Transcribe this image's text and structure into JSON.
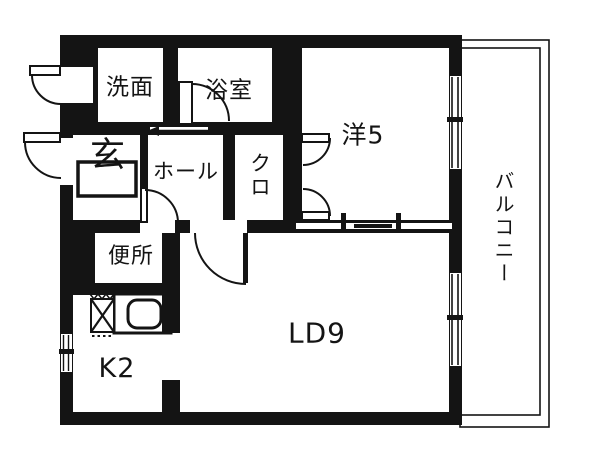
{
  "type": "apartment-floor-plan",
  "colors": {
    "ink": "#141414",
    "bg": "#ffffff"
  },
  "rooms": [
    {
      "id": "washroom",
      "label": "洗面"
    },
    {
      "id": "bathroom",
      "label": "浴室"
    },
    {
      "id": "western-room",
      "label": "洋5"
    },
    {
      "id": "entrance",
      "label": "玄"
    },
    {
      "id": "hall",
      "label": "ホール"
    },
    {
      "id": "closet",
      "label": "クロ"
    },
    {
      "id": "toilet",
      "label": "便所"
    },
    {
      "id": "kitchen",
      "label": "K2"
    },
    {
      "id": "living-dining",
      "label": "LD9"
    },
    {
      "id": "balcony",
      "label": "バルコニー"
    }
  ],
  "symbols": {
    "door_swing": "quarter-arc",
    "sliding_door": "arrow-line",
    "double_sliding_door": "offset-slits",
    "window": "double-line-with-mullion",
    "sink": "rounded-rectangle",
    "stove": "crossed-box",
    "entrance_step": "outlined-rectangle"
  }
}
